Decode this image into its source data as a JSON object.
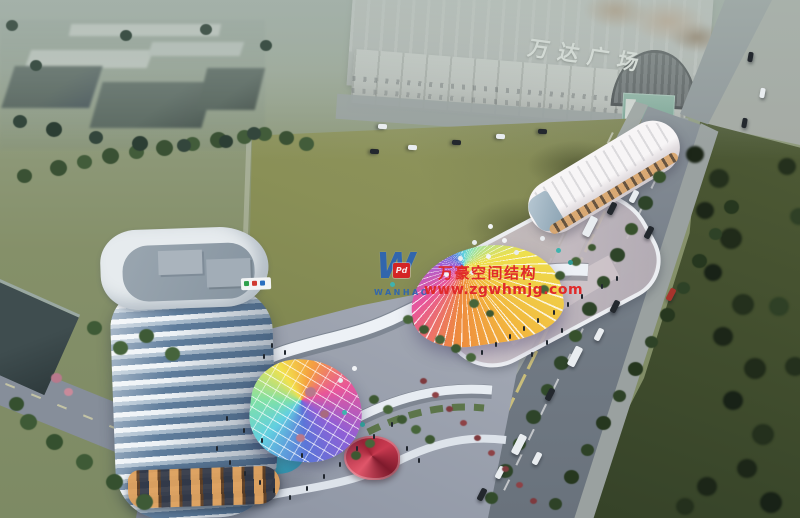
{
  "signs": {
    "mall_roof_sign": "万达广场"
  },
  "watermark": {
    "logo_letter": "W",
    "logo_badge": "Pd",
    "logo_name": "WANHAO",
    "company_cn": "万豪空间结构",
    "website": "www.zgwhmjg.com"
  },
  "palette": {
    "watermark_red": "#e02a2a",
    "logo_blue": "#2a63b5",
    "badge_red": "#d42525",
    "field_olive": "#8a9057",
    "lawn_green": "#39462a",
    "road_grey": "#79828c",
    "tower_glass_blue": "#5f7d9c",
    "canopy_rainbow": [
      "#f2e14e",
      "#f4a03f",
      "#e8559a",
      "#8f5fd6",
      "#5b76d8",
      "#62cfe0",
      "#7fe0a8"
    ]
  }
}
